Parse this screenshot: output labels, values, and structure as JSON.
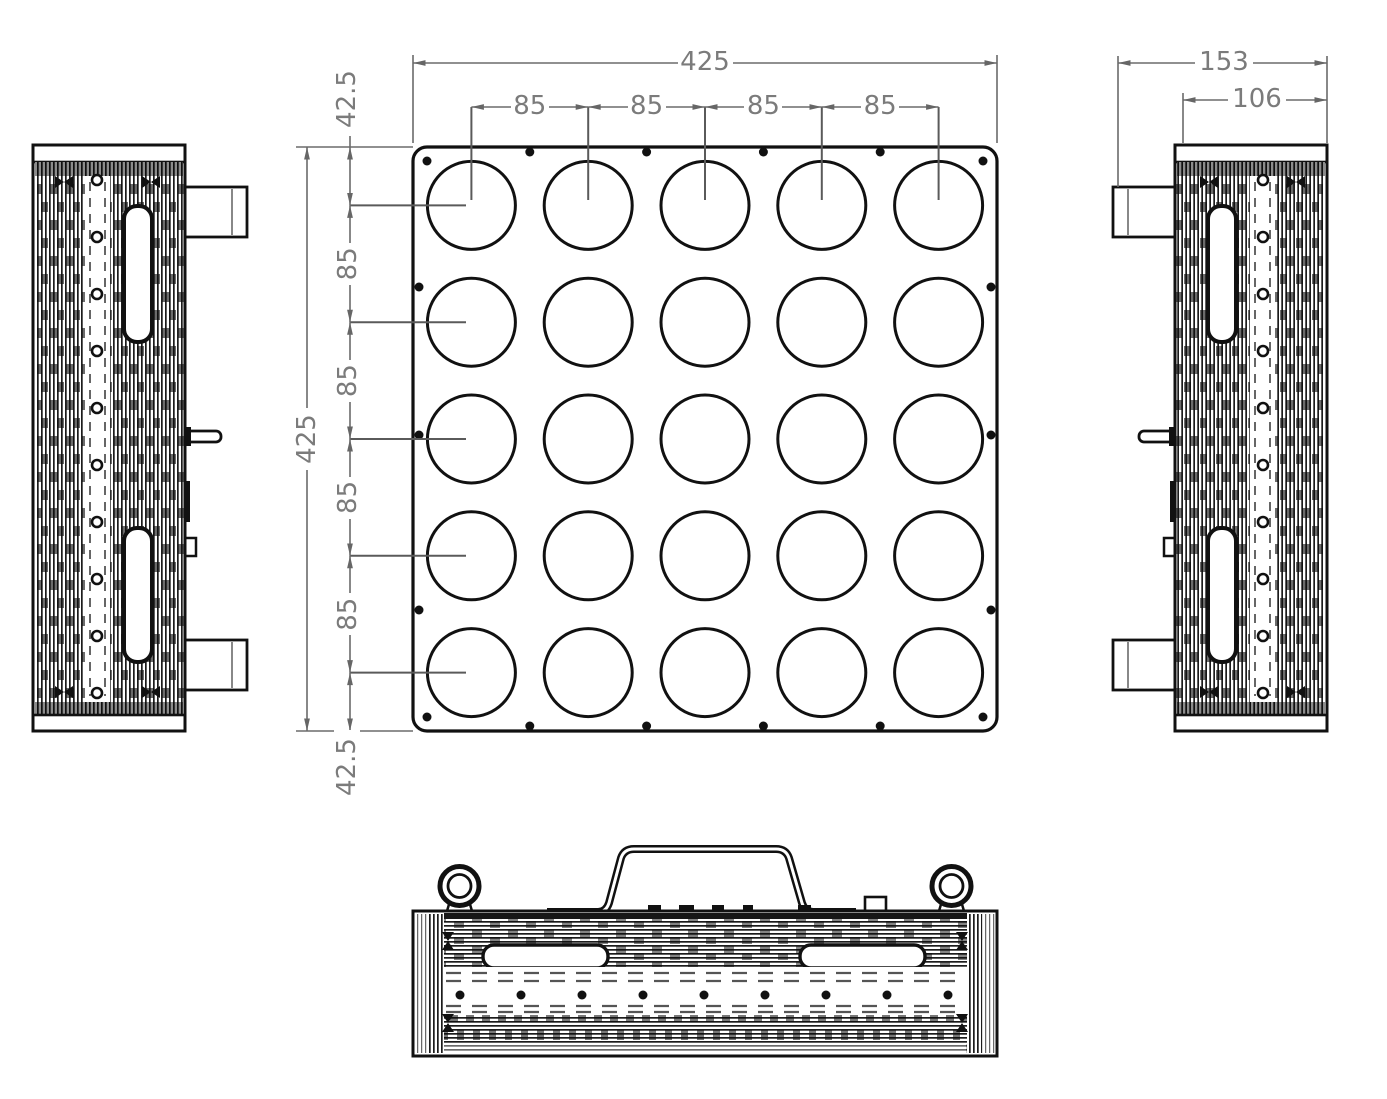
{
  "drawing": {
    "type": "mechanical-orthographic-views",
    "views": [
      "front-view",
      "left-side-view",
      "right-side-view",
      "bottom-view"
    ],
    "dims": {
      "front": {
        "overall_width": "425",
        "overall_height": "425",
        "pitch": [
          "85",
          "85",
          "85",
          "85"
        ],
        "chain": [
          "42.5",
          "85",
          "85",
          "85",
          "85",
          "42.5"
        ]
      },
      "side": {
        "overall": "153",
        "body": "106"
      }
    },
    "colors": {
      "line_black": "#111111",
      "dim_gray": "#6b6b6b",
      "text_gray": "#7b7b7b",
      "background": "#ffffff"
    }
  }
}
